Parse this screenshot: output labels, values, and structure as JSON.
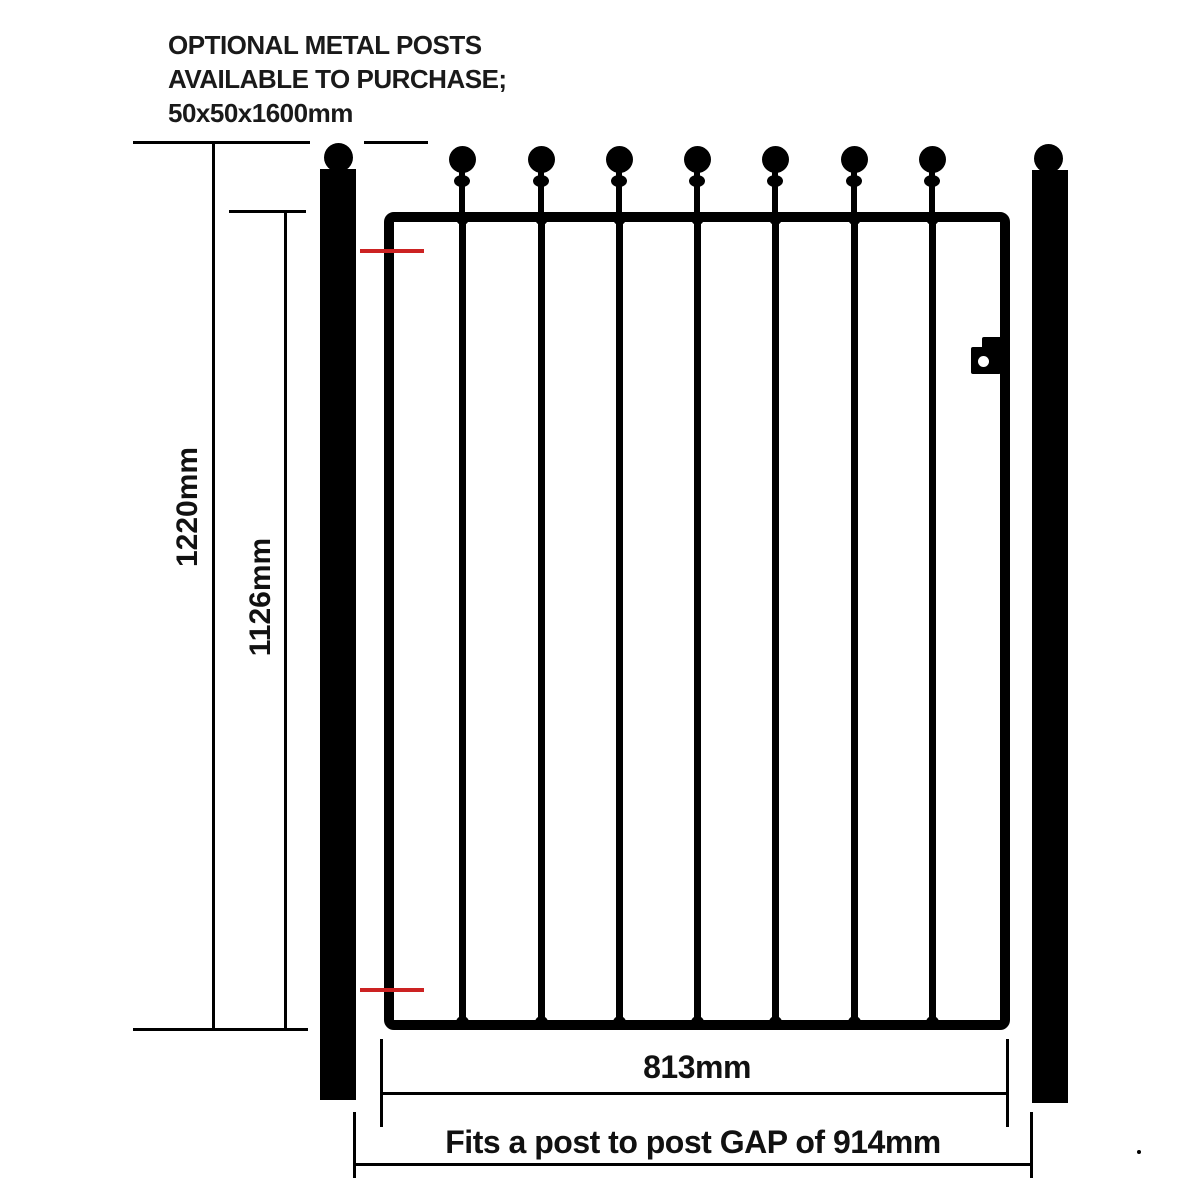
{
  "note": {
    "line1": "OPTIONAL METAL POSTS",
    "line2": "AVAILABLE TO PURCHASE;",
    "line3": "50x50x1600mm"
  },
  "dimensions": {
    "overall_height_label": "1220mm",
    "gate_height_label": "1126mm",
    "gate_width_label": "813mm",
    "gap_label": "Fits a post to post GAP of 914mm"
  },
  "gate": {
    "bar_count": 7,
    "finial_style": "ball-top",
    "frame_left": 384,
    "frame_width": 626
  },
  "colors": {
    "ink": "#000000",
    "background": "#ffffff",
    "hinge_marker_red": "#cc2222"
  }
}
